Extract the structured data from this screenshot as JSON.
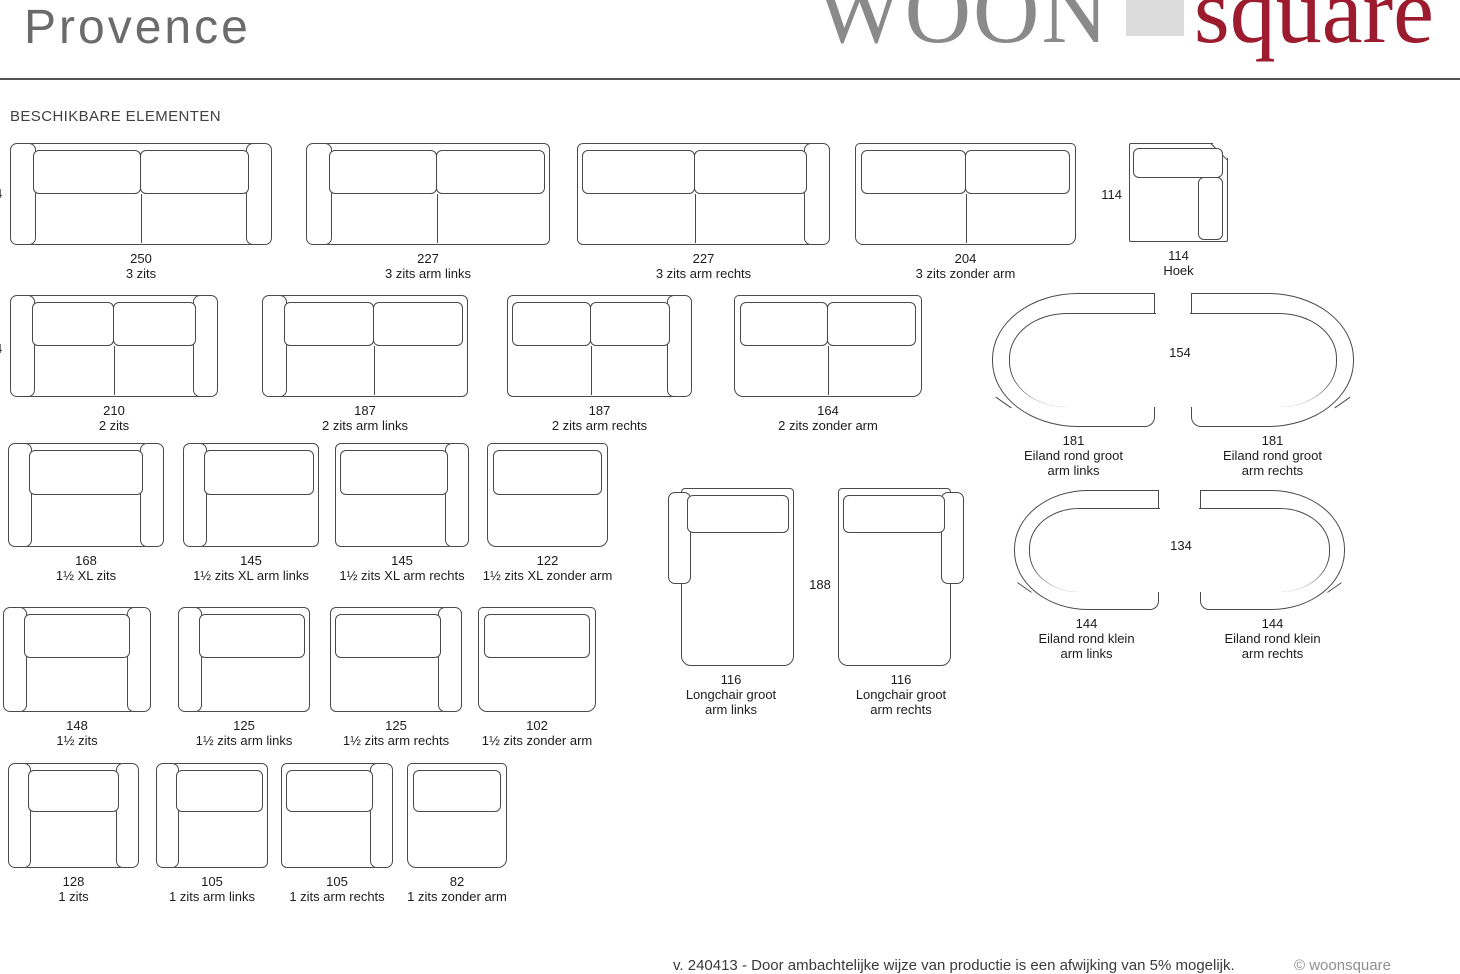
{
  "title": "Provence",
  "logo": {
    "woon": "WOON",
    "square": "square"
  },
  "heading": "BESCHIKBARE ELEMENTEN",
  "edge_dims": {
    "row1": "4",
    "row2": "4"
  },
  "dims": {
    "hoek_side": "114",
    "eiland_groot_depth": "154",
    "longchair_depth": "188",
    "eiland_klein_depth": "134"
  },
  "elements": {
    "zits3": [
      {
        "size": "250",
        "name": "3 zits"
      },
      {
        "size": "227",
        "name": "3 zits arm links"
      },
      {
        "size": "227",
        "name": "3 zits arm rechts"
      },
      {
        "size": "204",
        "name": "3 zits zonder arm"
      }
    ],
    "hoek": {
      "size": "114",
      "name": "Hoek"
    },
    "zits2": [
      {
        "size": "210",
        "name": "2 zits"
      },
      {
        "size": "187",
        "name": "2 zits arm links"
      },
      {
        "size": "187",
        "name": "2 zits arm rechts"
      },
      {
        "size": "164",
        "name": "2 zits zonder arm"
      }
    ],
    "eiland_groot": [
      {
        "size": "181",
        "name": "Eiland rond groot",
        "sub": "arm links"
      },
      {
        "size": "181",
        "name": "Eiland rond groot",
        "sub": "arm rechts"
      }
    ],
    "zits15xl": [
      {
        "size": "168",
        "name": "1½ XL zits"
      },
      {
        "size": "145",
        "name": "1½ zits XL arm links"
      },
      {
        "size": "145",
        "name": "1½ zits XL arm rechts"
      },
      {
        "size": "122",
        "name": "1½ zits XL zonder arm"
      }
    ],
    "longchair": [
      {
        "size": "116",
        "name": "Longchair groot",
        "sub": "arm links"
      },
      {
        "size": "116",
        "name": "Longchair groot",
        "sub": "arm rechts"
      }
    ],
    "eiland_klein": [
      {
        "size": "144",
        "name": "Eiland rond klein",
        "sub": "arm links"
      },
      {
        "size": "144",
        "name": "Eiland rond klein",
        "sub": "arm rechts"
      }
    ],
    "zits15": [
      {
        "size": "148",
        "name": "1½ zits"
      },
      {
        "size": "125",
        "name": "1½ zits arm links"
      },
      {
        "size": "125",
        "name": "1½ zits arm rechts"
      },
      {
        "size": "102",
        "name": "1½ zits zonder arm"
      }
    ],
    "zits1": [
      {
        "size": "128",
        "name": "1 zits"
      },
      {
        "size": "105",
        "name": "1 zits arm links"
      },
      {
        "size": "105",
        "name": "1 zits arm rechts"
      },
      {
        "size": "82",
        "name": "1 zits zonder arm"
      }
    ]
  },
  "footer": {
    "note": "v. 240413 - Door ambachtelijke wijze van productie is een afwijking van 5% mogelijk.",
    "copyright": "© woonsquare"
  },
  "colors": {
    "brand_red": "#9c1b2e",
    "brand_gray": "#8a8a8b",
    "logo_block_gray": "#dcdcdc",
    "line": "#4a4a4a"
  }
}
